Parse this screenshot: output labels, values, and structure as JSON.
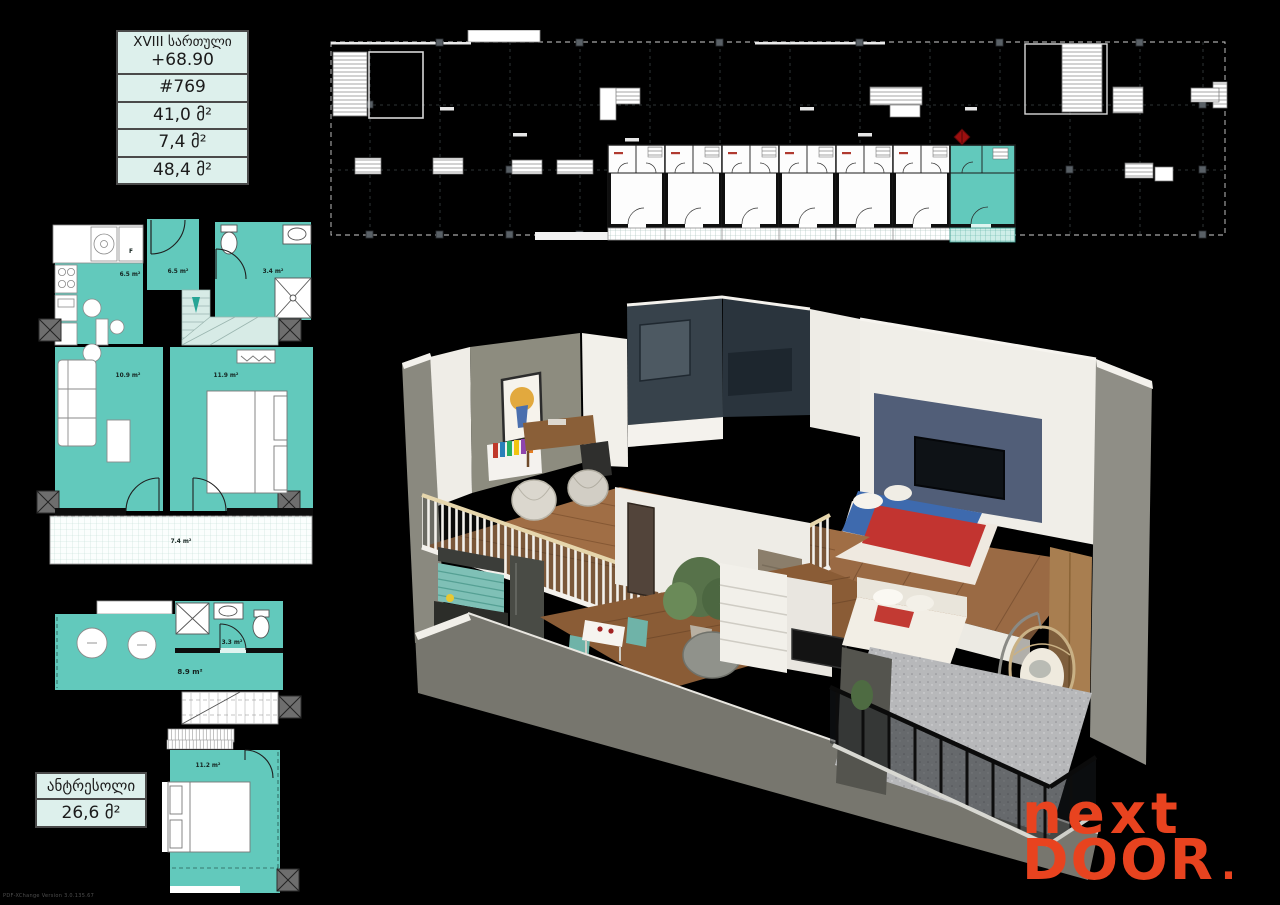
{
  "info_table": {
    "floor_label": "XVIII სართული",
    "elevation": "+68.90",
    "unit_number": "#769",
    "area_inner": "41,0 მ²",
    "area_balcony": "7,4 მ²",
    "area_total": "48,4 მ²"
  },
  "site_plan": {
    "highlight_color": "#62c9bc",
    "marker_color": "#9c0f0f"
  },
  "main_plan": {
    "kitchen_area": "6.5 m²",
    "hall_area": "6.5 m²",
    "bath_area": "3.4 m²",
    "living_area": "10.9 m²",
    "bedroom_area": "11.9 m²",
    "balcony_area": "7.4 m²",
    "fridge_label": "F"
  },
  "mezzanine_plan": {
    "room_area": "8.9 m²",
    "bath_area": "3.3 m²",
    "bedroom_area": "11.2 m²"
  },
  "mezzanine_label": {
    "title": "ანტრესოლი",
    "area": "26,6 მ²"
  },
  "logo": {
    "line1": "next",
    "line2": "DOOR",
    "dot": "."
  },
  "watermark": "PDF-XChange Version 3.0.135.67",
  "colors": {
    "teal": "#62c9bc",
    "mint_bg": "#ddf0ec",
    "logo_orange": "#e8431f"
  }
}
